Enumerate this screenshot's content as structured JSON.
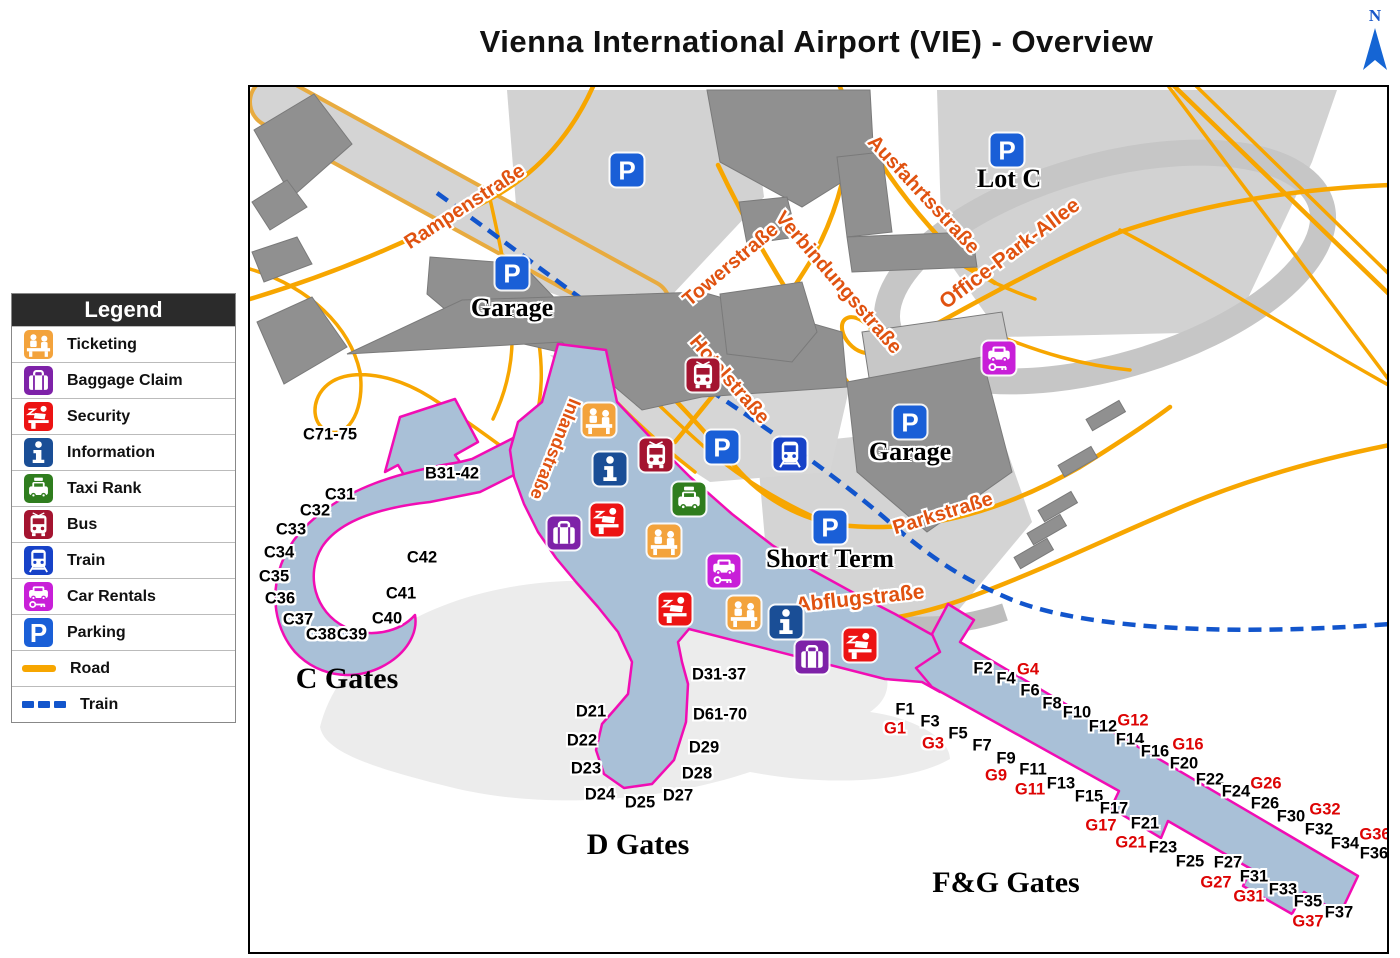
{
  "title": "Vienna International Airport (VIE) - Overview",
  "compass": {
    "label": "N"
  },
  "colors": {
    "road": "#f7a600",
    "rail": "#1255cc",
    "terminal_fill": "#a9c0d7",
    "terminal_outline": "#f10db4",
    "street_text": "#e05210",
    "gate_black": "#000000",
    "gate_red": "#dd0404",
    "ticketing": "#f3a33c",
    "baggage": "#7e22a8",
    "security": "#ec1313",
    "information": "#1a4e96",
    "taxi": "#2f7d1e",
    "bus": "#a41430",
    "train": "#1742c8",
    "car_rentals": "#c81fd8",
    "parking": "#1a5fd7"
  },
  "legend": {
    "title": "Legend",
    "items": [
      {
        "icon": "ticketing",
        "label": "Ticketing",
        "color": "#f3a33c"
      },
      {
        "icon": "baggage",
        "label": "Baggage Claim",
        "color": "#7e22a8"
      },
      {
        "icon": "security",
        "label": "Security",
        "color": "#ec1313"
      },
      {
        "icon": "information",
        "label": "Information",
        "color": "#1a4e96"
      },
      {
        "icon": "taxi",
        "label": "Taxi Rank",
        "color": "#2f7d1e"
      },
      {
        "icon": "bus",
        "label": "Bus",
        "color": "#a41430"
      },
      {
        "icon": "train",
        "label": "Train",
        "color": "#1742c8"
      },
      {
        "icon": "car-rentals",
        "label": "Car Rentals",
        "color": "#c81fd8"
      },
      {
        "icon": "parking",
        "label": "Parking",
        "color": "#1a5fd7"
      },
      {
        "icon": "road",
        "label": "Road",
        "color": "#f7a600"
      },
      {
        "icon": "train-line",
        "label": "Train",
        "color": "#1255cc"
      }
    ]
  },
  "map": {
    "street_labels": [
      {
        "text": "Rampenstraße",
        "x": 215,
        "y": 120,
        "rot": -33,
        "size": 20
      },
      {
        "text": "Towerstraße",
        "x": 481,
        "y": 178,
        "rot": -40,
        "size": 20
      },
      {
        "text": "Verbindungsstraße",
        "x": 588,
        "y": 196,
        "rot": 49,
        "size": 20
      },
      {
        "text": "Ausfahrtsstraße",
        "x": 673,
        "y": 108,
        "rot": 47,
        "size": 20
      },
      {
        "text": "Hotelstraße",
        "x": 479,
        "y": 293,
        "rot": 49,
        "size": 20
      },
      {
        "text": "Office-Park-Allee",
        "x": 760,
        "y": 167,
        "rot": -37,
        "size": 21
      },
      {
        "text": "Parkstraße",
        "x": 693,
        "y": 427,
        "rot": -17,
        "size": 20
      },
      {
        "text": "Abflugstraße",
        "x": 610,
        "y": 512,
        "rot": -6,
        "size": 21
      },
      {
        "text": "Inlandstraße",
        "x": 305,
        "y": 362,
        "rot": 112,
        "size": 18
      }
    ],
    "place_labels": [
      {
        "text": "Garage",
        "x": 262,
        "y": 221
      },
      {
        "text": "Garage",
        "x": 660,
        "y": 365
      },
      {
        "text": "Lot C",
        "x": 759,
        "y": 92
      },
      {
        "text": "Short Term",
        "x": 580,
        "y": 472
      }
    ],
    "area_labels": [
      {
        "text": "C Gates",
        "x": 97,
        "y": 592
      },
      {
        "text": "D Gates",
        "x": 388,
        "y": 758
      },
      {
        "text": "F&G Gates",
        "x": 756,
        "y": 796
      }
    ],
    "gate_labels": [
      {
        "text": "C71-75",
        "x": 80,
        "y": 348,
        "red": false
      },
      {
        "text": "B31-42",
        "x": 202,
        "y": 387,
        "red": false
      },
      {
        "text": "C31",
        "x": 90,
        "y": 408,
        "red": false
      },
      {
        "text": "C32",
        "x": 65,
        "y": 424,
        "red": false
      },
      {
        "text": "C33",
        "x": 41,
        "y": 443,
        "red": false
      },
      {
        "text": "C34",
        "x": 29,
        "y": 466,
        "red": false
      },
      {
        "text": "C35",
        "x": 24,
        "y": 490,
        "red": false
      },
      {
        "text": "C36",
        "x": 30,
        "y": 512,
        "red": false
      },
      {
        "text": "C37",
        "x": 48,
        "y": 533,
        "red": false
      },
      {
        "text": "C38",
        "x": 71,
        "y": 548,
        "red": false
      },
      {
        "text": "C39",
        "x": 102,
        "y": 548,
        "red": false
      },
      {
        "text": "C40",
        "x": 137,
        "y": 532,
        "red": false
      },
      {
        "text": "C41",
        "x": 151,
        "y": 507,
        "red": false
      },
      {
        "text": "C42",
        "x": 172,
        "y": 471,
        "red": false
      },
      {
        "text": "D21",
        "x": 341,
        "y": 625,
        "red": false
      },
      {
        "text": "D22",
        "x": 332,
        "y": 654,
        "red": false
      },
      {
        "text": "D23",
        "x": 336,
        "y": 682,
        "red": false
      },
      {
        "text": "D24",
        "x": 350,
        "y": 708,
        "red": false
      },
      {
        "text": "D25",
        "x": 390,
        "y": 716,
        "red": false
      },
      {
        "text": "D27",
        "x": 428,
        "y": 709,
        "red": false
      },
      {
        "text": "D28",
        "x": 447,
        "y": 687,
        "red": false
      },
      {
        "text": "D29",
        "x": 454,
        "y": 661,
        "red": false
      },
      {
        "text": "D31-37",
        "x": 469,
        "y": 588,
        "red": false
      },
      {
        "text": "D61-70",
        "x": 470,
        "y": 628,
        "red": false
      },
      {
        "text": "F1",
        "x": 655,
        "y": 623,
        "red": false
      },
      {
        "text": "F2",
        "x": 733,
        "y": 582,
        "red": false
      },
      {
        "text": "F3",
        "x": 680,
        "y": 635,
        "red": false
      },
      {
        "text": "F4",
        "x": 756,
        "y": 592,
        "red": false
      },
      {
        "text": "F5",
        "x": 708,
        "y": 647,
        "red": false
      },
      {
        "text": "F6",
        "x": 780,
        "y": 604,
        "red": false
      },
      {
        "text": "F7",
        "x": 732,
        "y": 659,
        "red": false
      },
      {
        "text": "F8",
        "x": 802,
        "y": 617,
        "red": false
      },
      {
        "text": "F9",
        "x": 756,
        "y": 672,
        "red": false
      },
      {
        "text": "F10",
        "x": 827,
        "y": 626,
        "red": false
      },
      {
        "text": "F11",
        "x": 783,
        "y": 683,
        "red": false
      },
      {
        "text": "F12",
        "x": 853,
        "y": 640,
        "red": false
      },
      {
        "text": "F13",
        "x": 811,
        "y": 697,
        "red": false
      },
      {
        "text": "F14",
        "x": 880,
        "y": 653,
        "red": false
      },
      {
        "text": "F15",
        "x": 839,
        "y": 710,
        "red": false
      },
      {
        "text": "F16",
        "x": 905,
        "y": 665,
        "red": false
      },
      {
        "text": "F17",
        "x": 864,
        "y": 722,
        "red": false
      },
      {
        "text": "F20",
        "x": 934,
        "y": 677,
        "red": false
      },
      {
        "text": "F21",
        "x": 895,
        "y": 737,
        "red": false
      },
      {
        "text": "F22",
        "x": 960,
        "y": 693,
        "red": false
      },
      {
        "text": "F23",
        "x": 913,
        "y": 761,
        "red": false
      },
      {
        "text": "F24",
        "x": 986,
        "y": 705,
        "red": false
      },
      {
        "text": "F25",
        "x": 940,
        "y": 775,
        "red": false
      },
      {
        "text": "F26",
        "x": 1015,
        "y": 717,
        "red": false
      },
      {
        "text": "F27",
        "x": 978,
        "y": 776,
        "red": false
      },
      {
        "text": "F30",
        "x": 1041,
        "y": 730,
        "red": false
      },
      {
        "text": "F31",
        "x": 1004,
        "y": 790,
        "red": false
      },
      {
        "text": "F32",
        "x": 1069,
        "y": 743,
        "red": false
      },
      {
        "text": "F33",
        "x": 1033,
        "y": 803,
        "red": false
      },
      {
        "text": "F34",
        "x": 1095,
        "y": 757,
        "red": false
      },
      {
        "text": "F35",
        "x": 1058,
        "y": 815,
        "red": false
      },
      {
        "text": "F36",
        "x": 1124,
        "y": 767,
        "red": false
      },
      {
        "text": "F37",
        "x": 1089,
        "y": 826,
        "red": false
      },
      {
        "text": "G1",
        "x": 645,
        "y": 642,
        "red": true
      },
      {
        "text": "G3",
        "x": 683,
        "y": 657,
        "red": true
      },
      {
        "text": "G4",
        "x": 778,
        "y": 583,
        "red": true
      },
      {
        "text": "G9",
        "x": 746,
        "y": 689,
        "red": true
      },
      {
        "text": "G11",
        "x": 780,
        "y": 703,
        "red": true
      },
      {
        "text": "G12",
        "x": 883,
        "y": 634,
        "red": true
      },
      {
        "text": "G16",
        "x": 938,
        "y": 658,
        "red": true
      },
      {
        "text": "G17",
        "x": 851,
        "y": 739,
        "red": true
      },
      {
        "text": "G21",
        "x": 881,
        "y": 756,
        "red": true
      },
      {
        "text": "G26",
        "x": 1016,
        "y": 697,
        "red": true
      },
      {
        "text": "G27",
        "x": 966,
        "y": 796,
        "red": true
      },
      {
        "text": "G31",
        "x": 999,
        "y": 810,
        "red": true
      },
      {
        "text": "G32",
        "x": 1075,
        "y": 723,
        "red": true
      },
      {
        "text": "G36",
        "x": 1125,
        "y": 748,
        "red": true
      },
      {
        "text": "G37",
        "x": 1058,
        "y": 835,
        "red": true
      }
    ],
    "pois": [
      {
        "type": "parking",
        "x": 377,
        "y": 83
      },
      {
        "type": "parking",
        "x": 757,
        "y": 63
      },
      {
        "type": "parking",
        "x": 262,
        "y": 186
      },
      {
        "type": "parking",
        "x": 660,
        "y": 335
      },
      {
        "type": "parking",
        "x": 472,
        "y": 360
      },
      {
        "type": "parking",
        "x": 580,
        "y": 440
      },
      {
        "type": "car-rentals",
        "x": 749,
        "y": 271
      },
      {
        "type": "bus",
        "x": 453,
        "y": 288
      },
      {
        "type": "ticketing",
        "x": 349,
        "y": 333
      },
      {
        "type": "bus",
        "x": 406,
        "y": 368
      },
      {
        "type": "train",
        "x": 540,
        "y": 367
      },
      {
        "type": "information",
        "x": 360,
        "y": 382
      },
      {
        "type": "taxi",
        "x": 439,
        "y": 412
      },
      {
        "type": "security",
        "x": 357,
        "y": 433
      },
      {
        "type": "baggage",
        "x": 314,
        "y": 446
      },
      {
        "type": "ticketing",
        "x": 414,
        "y": 454
      },
      {
        "type": "car-rentals",
        "x": 474,
        "y": 484
      },
      {
        "type": "security",
        "x": 425,
        "y": 522
      },
      {
        "type": "ticketing",
        "x": 494,
        "y": 526
      },
      {
        "type": "information",
        "x": 536,
        "y": 535
      },
      {
        "type": "baggage",
        "x": 562,
        "y": 570
      },
      {
        "type": "security",
        "x": 610,
        "y": 558
      }
    ]
  }
}
